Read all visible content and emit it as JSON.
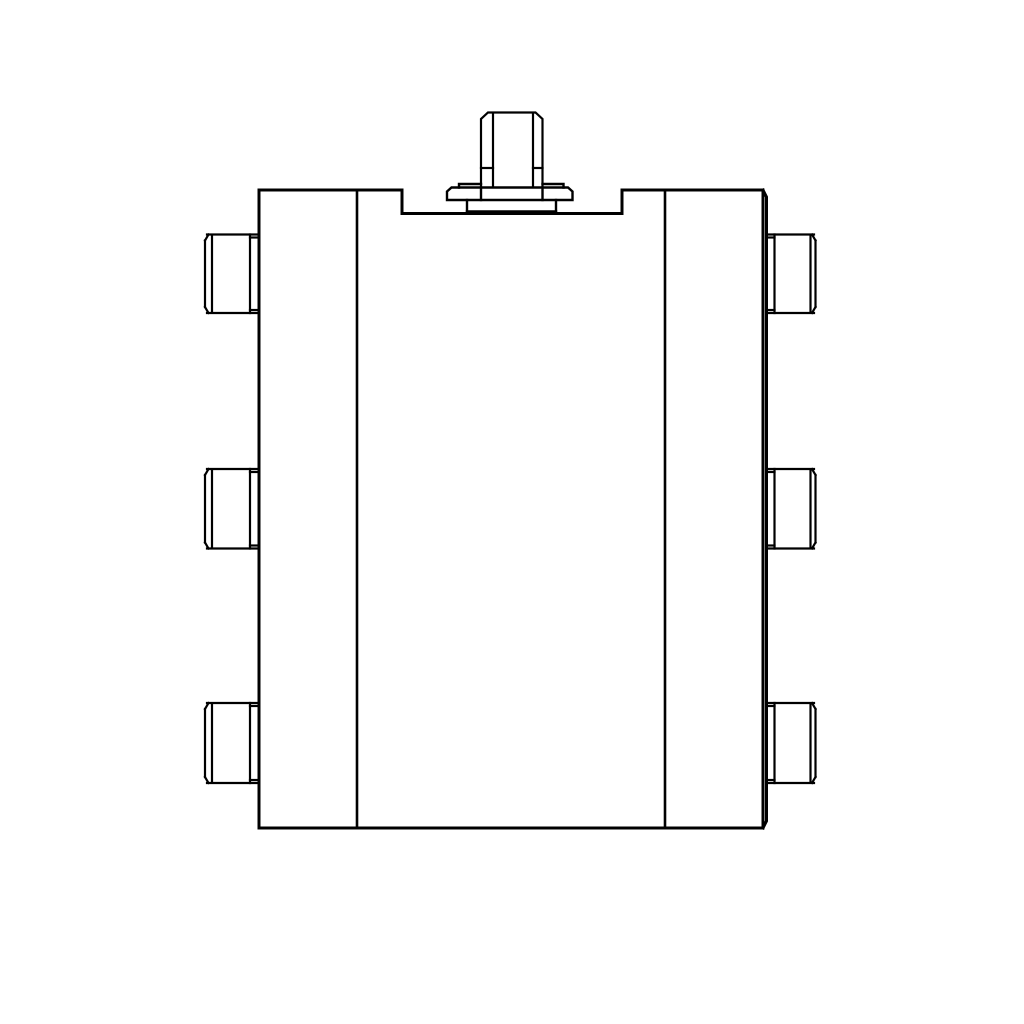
{
  "page": {
    "background_color": "#ffffff",
    "content_type": "technical-line-drawing"
  },
  "drawing": {
    "subject": "valve-manifold-block-front-view",
    "line_color": "#000000",
    "canvas": {
      "width": 1024,
      "height": 1024
    },
    "components": [
      {
        "name": "main-body-outline",
        "stroke_width": 3,
        "paths": [
          "M259,828 L259,190 L402,190 L402,213.5 L622,213.5 L622,190 L763,190 L763,828 L259,828",
          "M763,190 L766.5,197 L766.5,821 L763,828"
        ]
      },
      {
        "name": "panel-divider-left",
        "stroke_width": 2.6,
        "paths": [
          "M357,191 L357,827"
        ]
      },
      {
        "name": "panel-divider-right",
        "stroke_width": 2.6,
        "paths": [
          "M665,191 L665,827"
        ]
      },
      {
        "name": "top-fitting-stem",
        "stroke_width": 2.2,
        "paths": [
          "M481,187 L481,119 L488,112.5 L535.5,112.5 L542.5,119 L542.5,187",
          "M493,114 L493,187",
          "M533,114 L533,187",
          "M481,168 L493,168",
          "M533,168 L542.5,168"
        ]
      },
      {
        "name": "top-fitting-flange",
        "stroke_width": 2.4,
        "paths": [
          "M447,200 L447,191.5 L451.5,187.5 L568,187.5 L572.5,191.5 L572.5,200 L447,200",
          "M459,187.5 L459,184 L481,184",
          "M542.5,184 L563.5,184 L563.5,187.5",
          "M481,187.5 L481,200",
          "M542.5,187.5 L542.5,200"
        ]
      },
      {
        "name": "top-fitting-base-block",
        "stroke_width": 2.4,
        "paths": [
          "M467,200 L467,213.5",
          "M556,200 L556,213.5",
          "M467,211.5 L556,211.5"
        ]
      },
      {
        "name": "port-boss-left-top",
        "stroke_width": 2.2,
        "paths": [
          "M207,234.5 L259,234.5",
          "M207,313 L259,313",
          "M250,234.5 L250,313",
          "M250,237.5 L259,237.5",
          "M250,310 L259,310",
          "M212,236 L212,311.5",
          "M205,240.5 L205,307",
          "M205,240.5 L208.5,234.5",
          "M205,307 L208.5,313"
        ]
      },
      {
        "name": "port-boss-left-middle",
        "stroke_width": 2.2,
        "paths": [
          "M207,469 L259,469",
          "M207,548.5 L259,548.5",
          "M250,469 L250,548.5",
          "M250,472 L259,472",
          "M250,545.5 L259,545.5",
          "M212,470.5 L212,547",
          "M205,475 L205,542.5",
          "M205,475 L208.5,469",
          "M205,542.5 L208.5,548.5"
        ]
      },
      {
        "name": "port-boss-left-bottom",
        "stroke_width": 2.2,
        "paths": [
          "M207,703 L259,703",
          "M207,783 L259,783",
          "M250,703 L250,783",
          "M250,706 L259,706",
          "M250,780 L259,780",
          "M212,704.5 L212,781.5",
          "M205,709 L205,777",
          "M205,709 L208.5,703",
          "M205,777 L208.5,783"
        ]
      },
      {
        "name": "port-boss-right-top",
        "stroke_width": 2.2,
        "paths": [
          "M766.5,234.5 L814,234.5",
          "M766.5,313 L814,313",
          "M774.5,234.5 L774.5,313",
          "M766.5,237.5 L774.5,237.5",
          "M766.5,310 L774.5,310",
          "M810.5,236 L810.5,311.5",
          "M815.5,240.5 L815.5,307",
          "M815.5,240.5 L812,234.5",
          "M815.5,307 L812,313"
        ]
      },
      {
        "name": "port-boss-right-middle",
        "stroke_width": 2.2,
        "paths": [
          "M766.5,469 L814,469",
          "M766.5,548.5 L814,548.5",
          "M774.5,469 L774.5,548.5",
          "M766.5,472 L774.5,472",
          "M766.5,545.5 L774.5,545.5",
          "M810.5,470.5 L810.5,547",
          "M815.5,475 L815.5,542.5",
          "M815.5,475 L812,469",
          "M815.5,542.5 L812,548.5"
        ]
      },
      {
        "name": "port-boss-right-bottom",
        "stroke_width": 2.2,
        "paths": [
          "M766.5,703 L814,703",
          "M766.5,783 L814,783",
          "M774.5,703 L774.5,783",
          "M766.5,706 L774.5,706",
          "M766.5,780 L774.5,780",
          "M810.5,704.5 L810.5,781.5",
          "M815.5,709 L815.5,777",
          "M815.5,709 L812,703",
          "M815.5,777 L812,783"
        ]
      }
    ]
  }
}
